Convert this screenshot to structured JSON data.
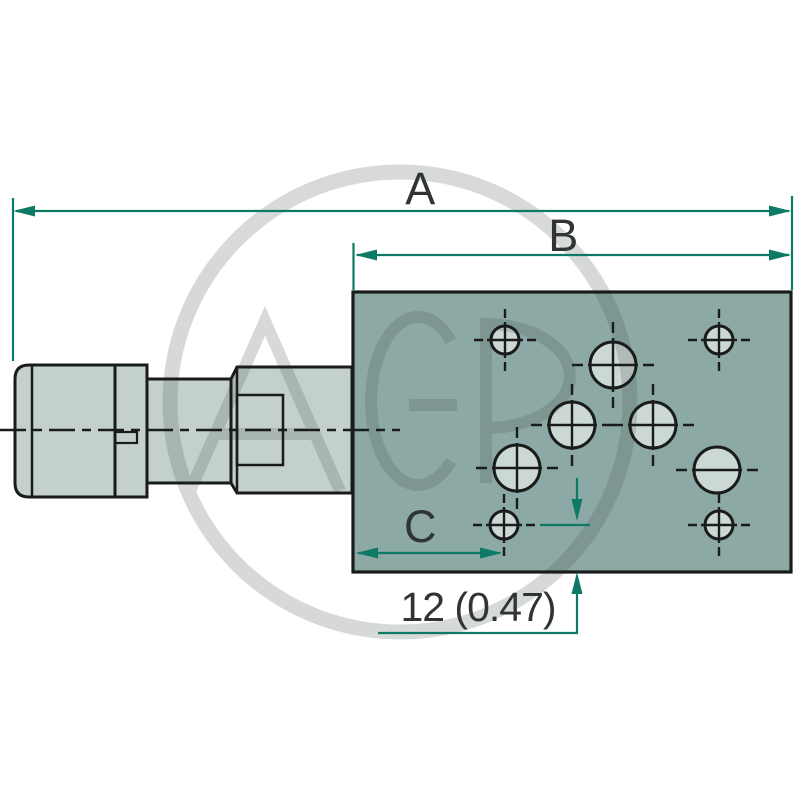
{
  "drawing": {
    "type": "technical-dimension-drawing",
    "subject": "hydraulic solenoid valve with mounting block, side view and port face",
    "labels": {
      "dim_a": "A",
      "dim_b": "B",
      "dim_c": "C",
      "dim_offset": "12 (0.47)"
    },
    "watermark": {
      "text": "AGP"
    },
    "colors": {
      "background": "#ffffff",
      "dimension_green": "#0d7a66",
      "outline_black": "#191c1b",
      "block_fill": "#8ca9a5",
      "valve_body_fill": "#c4d0cc",
      "hole_fill": "#ccd8d4",
      "label_text": "#303435",
      "watermark_gray": "#4d5854"
    }
  }
}
